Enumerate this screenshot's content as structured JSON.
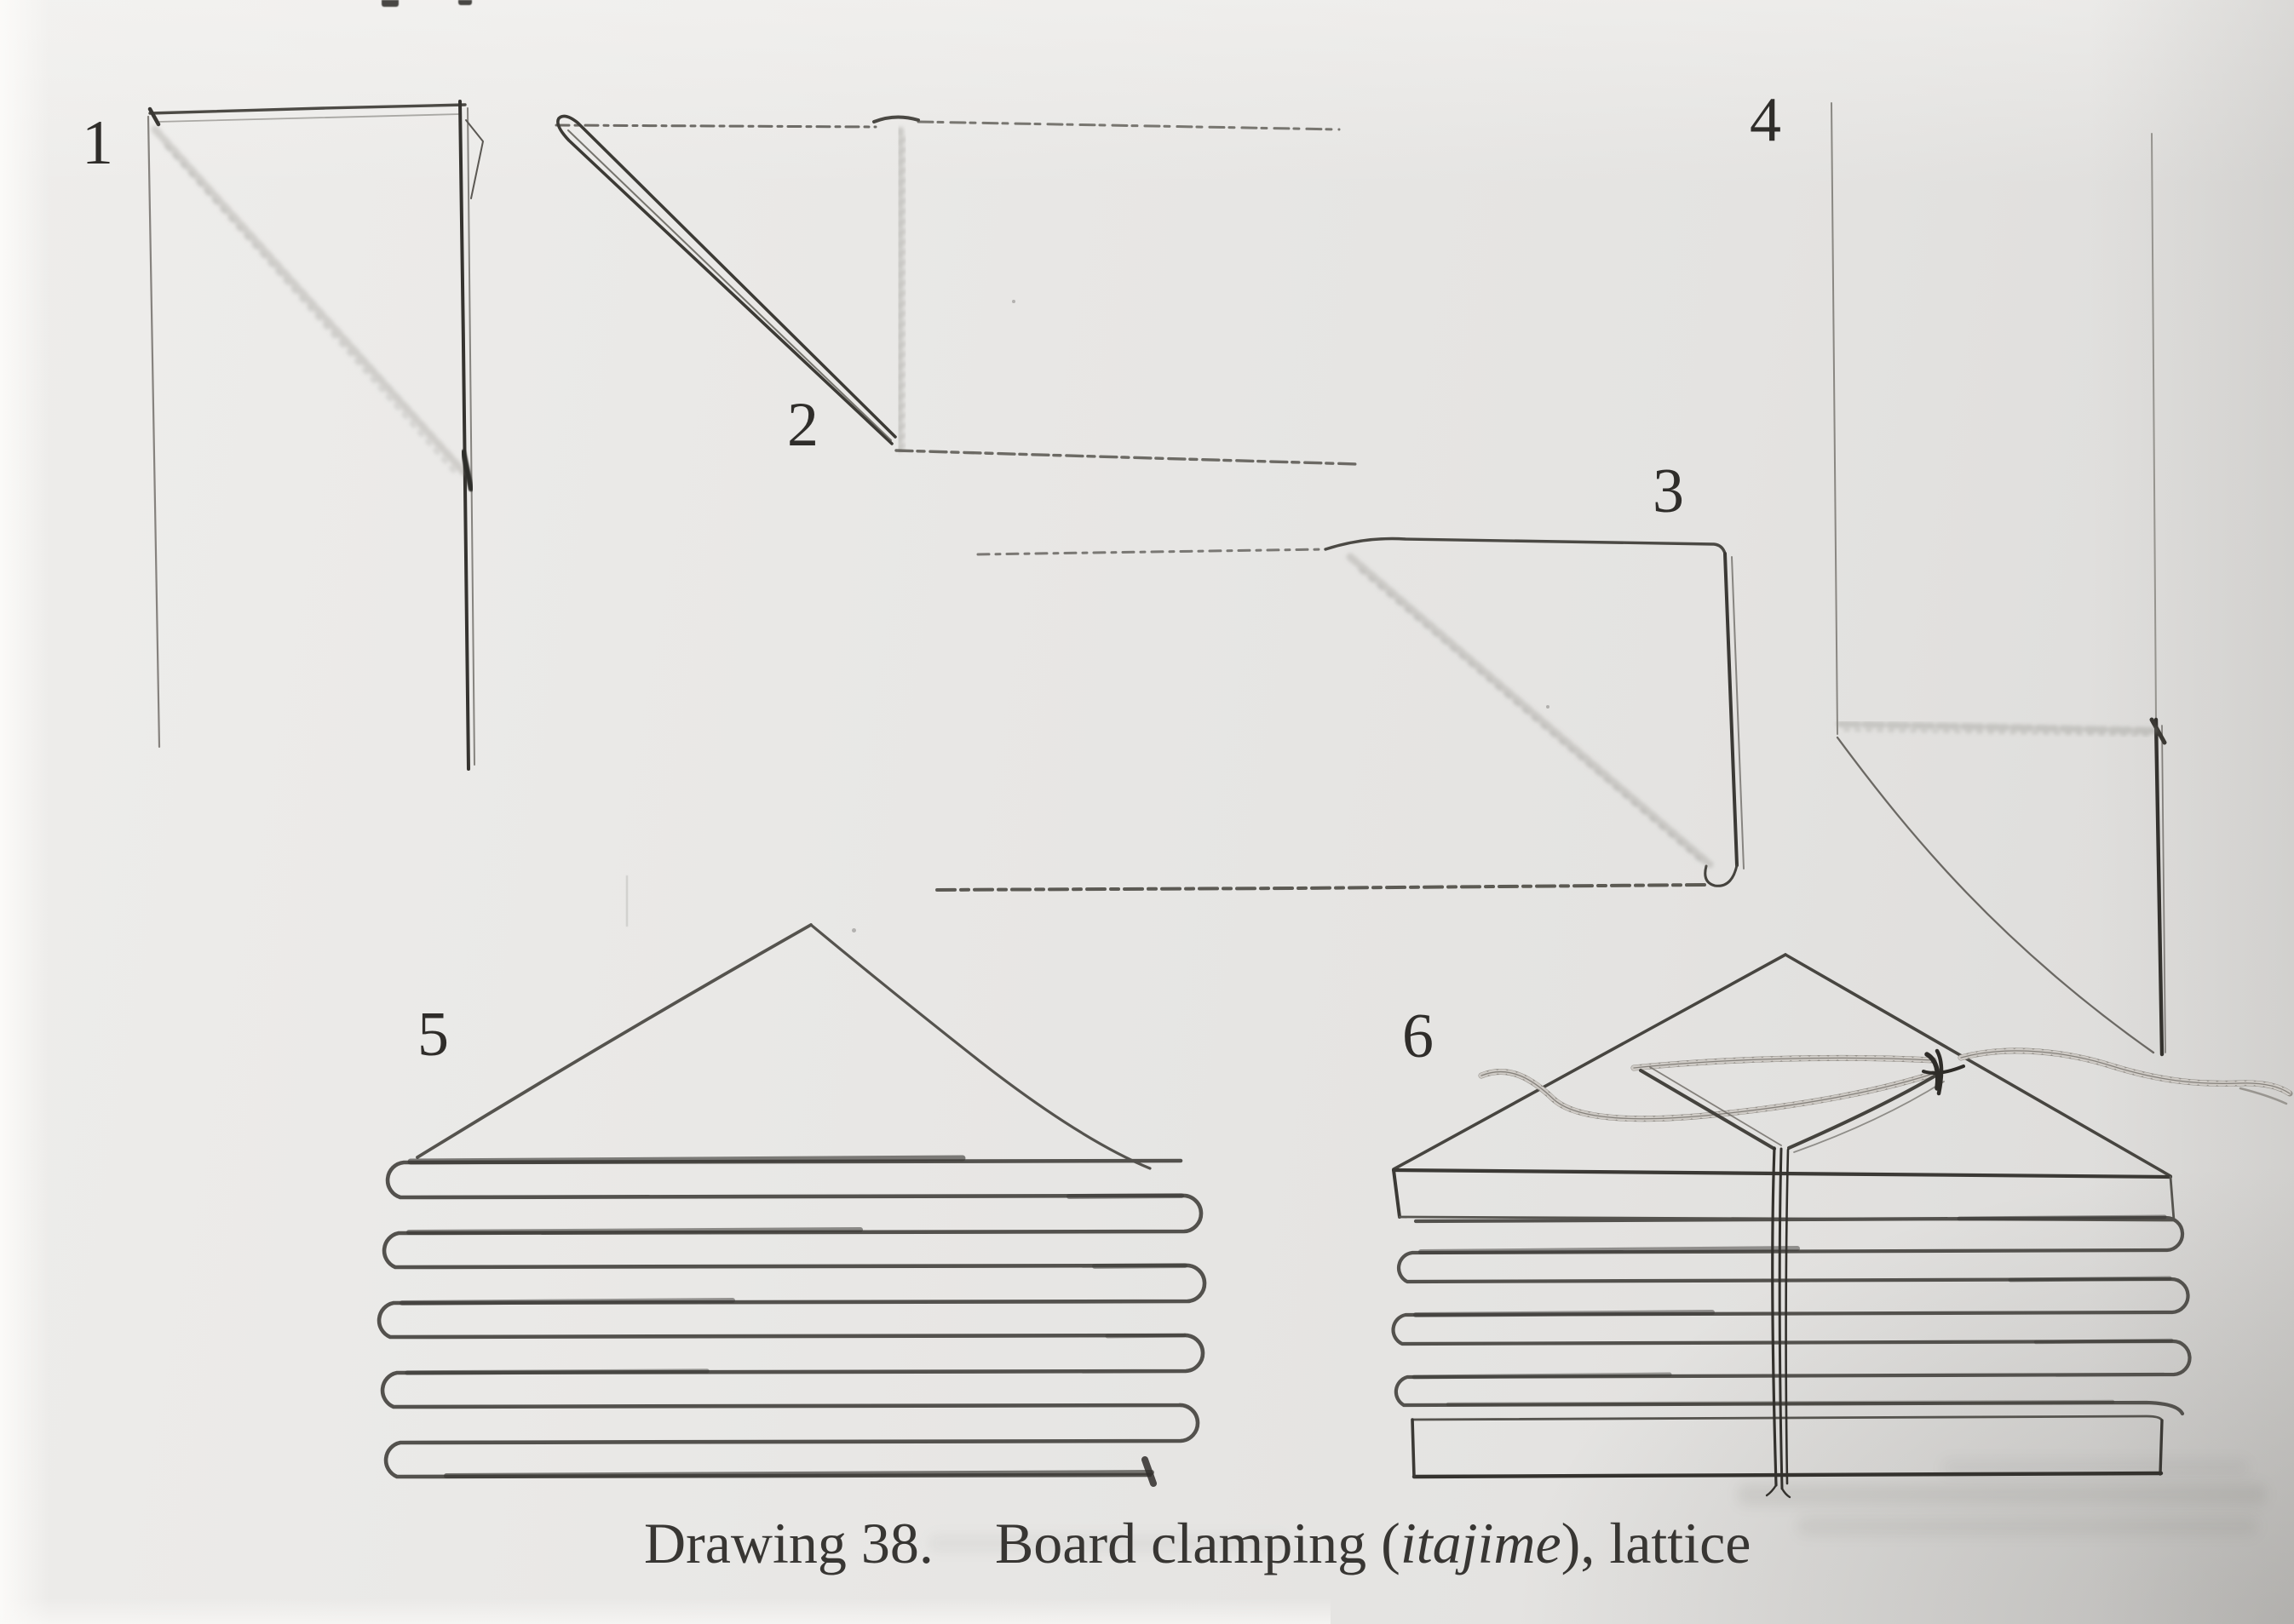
{
  "page": {
    "paper_color": "#e8e7e5",
    "pencil_color": "#4c4a46",
    "ink_dark": "#35332f",
    "cord_color": "#94908a"
  },
  "figure_labels": [
    "1",
    "2",
    "3",
    "4",
    "5",
    "6"
  ],
  "caption": {
    "number": "Drawing 38.",
    "body_start": "Board clamping (",
    "italic_term": "itajime",
    "body_end": "), lattice"
  }
}
